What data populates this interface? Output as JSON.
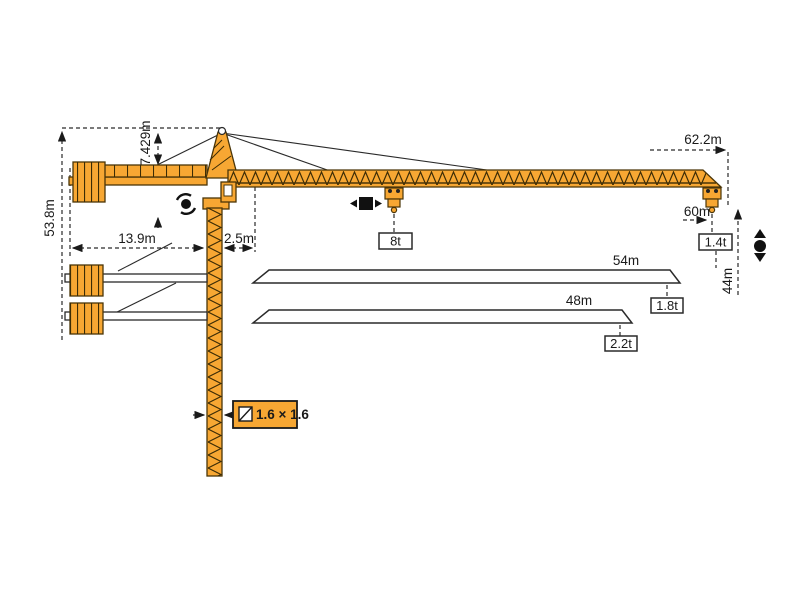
{
  "diagram": {
    "title": "tower-crane-dimension-diagram",
    "labels": {
      "total_height": "53.8m",
      "apex_height": "7.429m",
      "counterjib_radius": "13.9m",
      "rear_offset": "2.5m",
      "max_radius": "62.2m",
      "jib_60": "60m",
      "tip_load_60": "1.4t",
      "hook_height": "44m",
      "max_load": "8t",
      "jib_54": "54m",
      "tip_load_54": "1.8t",
      "jib_48": "48m",
      "tip_load_48": "2.2t",
      "mast_section": "1.6 × 1.6"
    },
    "icons": {
      "slewing": "rotate-arrows-around-dot",
      "trolley_travel": "black-square-left-right-arrows",
      "hoist": "black-dot-up-down-arrows",
      "mast_section_symbol": "square-with-diagonal"
    },
    "colors": {
      "crane_orange": "#F7A733",
      "outline_brown": "#4a3508",
      "line_black": "#2a2a2a",
      "white": "#ffffff"
    }
  }
}
